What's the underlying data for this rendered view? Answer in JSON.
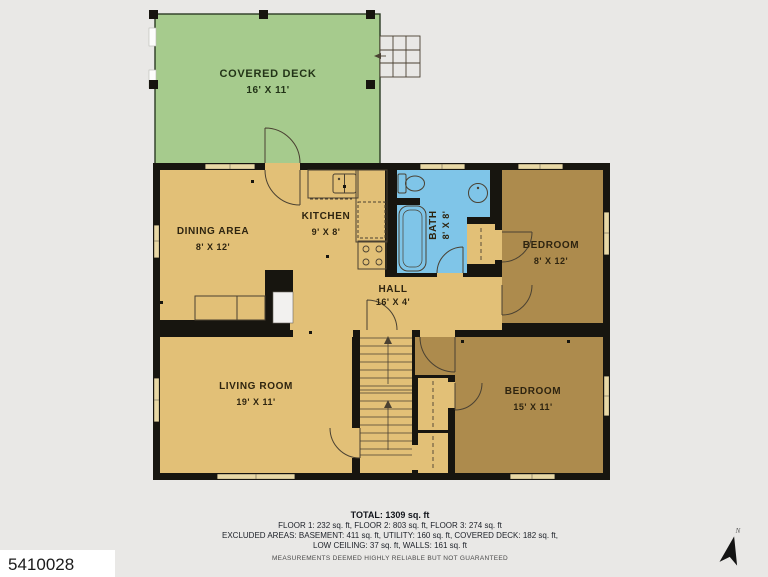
{
  "plan": {
    "type": "residential-floor-plan",
    "rooms": {
      "covered_deck": {
        "name": "COVERED DECK",
        "dims": "16' X 11'"
      },
      "dining": {
        "name": "DINING AREA",
        "dims": "8' X 12'"
      },
      "kitchen": {
        "name": "KITCHEN",
        "dims": "9' X 8'"
      },
      "bath": {
        "name": "BATH",
        "dims": "8' X 8'"
      },
      "bedroom1": {
        "name": "BEDROOM",
        "dims": "8' X 12'"
      },
      "hall": {
        "name": "HALL",
        "dims": "16' X 4'"
      },
      "living": {
        "name": "LIVING ROOM",
        "dims": "19' X 11'"
      },
      "bedroom2": {
        "name": "BEDROOM",
        "dims": "15' X 11'"
      }
    },
    "colors": {
      "background": "#e9e8e6",
      "deck_green": "#a6cb8d",
      "floor_light_tan": "#e2c077",
      "floor_dark_brown": "#ad8b4d",
      "bath_blue": "#7fc5e8",
      "walls_black": "#17150f",
      "window_fill": "#e8d8a6",
      "utility_white": "#f2f1ef"
    },
    "compass": {
      "label": "N"
    }
  },
  "footer": {
    "total": "TOTAL: 1309 sq. ft",
    "floors": "FLOOR 1: 232 sq. ft, FLOOR 2: 803 sq. ft, FLOOR 3: 274 sq. ft",
    "excluded1": "EXCLUDED AREAS: BASEMENT: 411 sq. ft, UTILITY: 160 sq. ft, COVERED DECK: 182 sq. ft,",
    "excluded2": "LOW CEILING: 37 sq. ft, WALLS: 161 sq. ft",
    "disclaimer": "MEASUREMENTS DEEMED HIGHLY RELIABLE BUT NOT GUARANTEED"
  },
  "listing_id": "5410028"
}
